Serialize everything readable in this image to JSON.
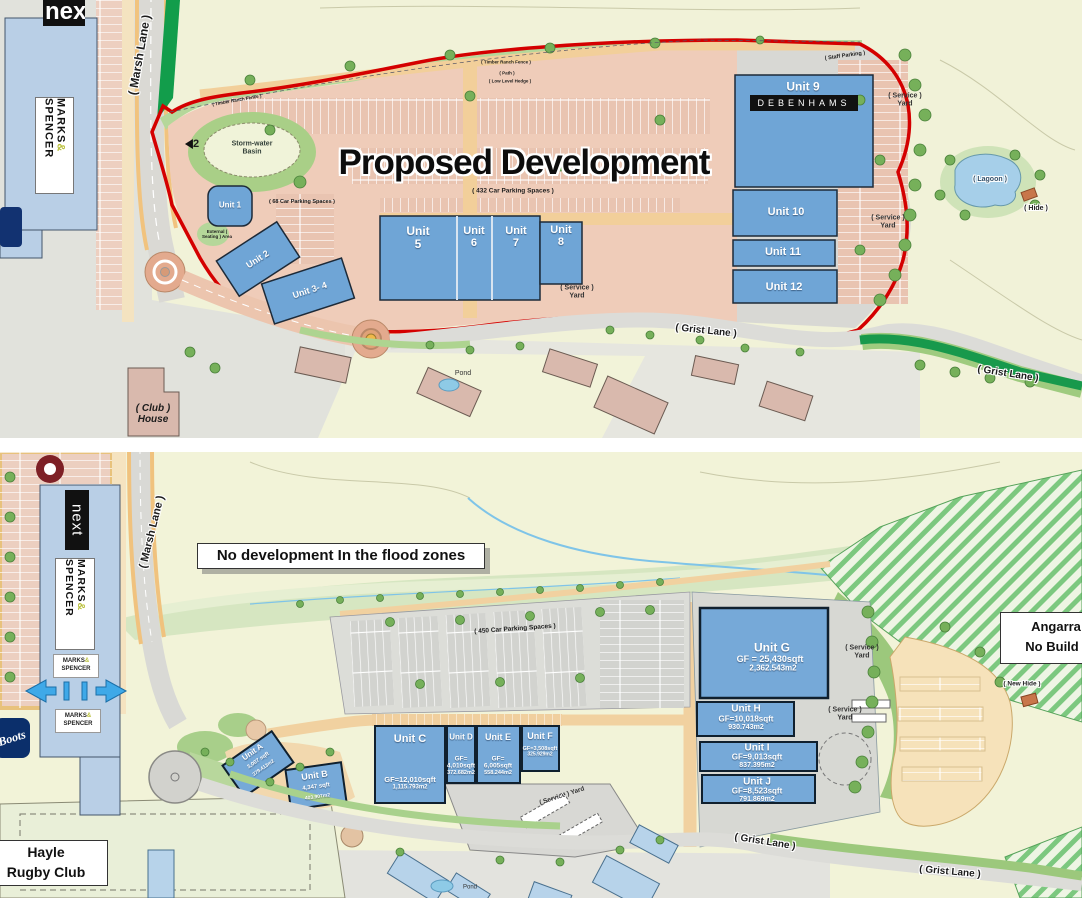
{
  "brands": {
    "next": "next",
    "marks_line1": "MARKS",
    "marks_amp": "&",
    "marks_line2": "SPENCER",
    "boots": "Boots"
  },
  "shared": {
    "service_line1": "( Service )",
    "service_line2": "Yard",
    "grist_lane": "( Grist Lane )",
    "marsh_lane": "( Marsh Lane )",
    "pond": "Pond"
  },
  "top_plan": {
    "title": "Proposed Development",
    "marker_2": "2",
    "storm_basin_l1": "Storm-water",
    "storm_basin_l2": "Basin",
    "parking_68": "( 68 Car Parking Spaces )",
    "parking_432": "( 432 Car Parking Spaces )",
    "external_seating": "External ( Seating ) Area",
    "staff_parking": "( Staff Parking )",
    "fence": "( Timber Ranch Fence )",
    "path": "( Path )",
    "hedge": "( Low Level Hedge )",
    "lagoon": "( Lagoon )",
    "hide": "( Hide )",
    "club_l1": "( Club )",
    "club_l2": "House",
    "units": {
      "u1": "Unit 1",
      "u2": "Unit 2",
      "u34": "Unit 3- 4",
      "u5w": "Unit",
      "u5n": "5",
      "u6w": "Unit",
      "u6n": "6",
      "u7w": "Unit",
      "u7n": "7",
      "u8w": "Unit",
      "u8n": "8",
      "u9": "Unit 9",
      "debenhams": "DEBENHAMS",
      "u10": "Unit 10",
      "u11": "Unit 11",
      "u12": "Unit 12"
    }
  },
  "bottom_plan": {
    "flood_note": "No development In the flood zones",
    "parking_450": "( 450 Car Parking Spaces )",
    "angarrack_l1": "Angarra",
    "angarrack_l2": "No Build (",
    "new_hide": "( New Hide )",
    "hayle_l1": "Hayle",
    "hayle_l2": "Rugby Club",
    "units": {
      "a_name": "Unit A",
      "a_sqft": "3,007 sqft",
      "a_m2": "279.413m2",
      "b_name": "Unit B",
      "b_sqft": "4,347 sqft",
      "b_m2": "403.907m2",
      "c_name": "Unit C",
      "c_gf": "GF=12,010sqft",
      "c_m2": "1,115.793m2",
      "d_name": "Unit D",
      "d_gf": "GF=",
      "d_sqft": "4,010sqft",
      "d_m2": "372.682m2",
      "e_name": "Unit E",
      "e_gf": "GF=",
      "e_sqft": "6,005sqft",
      "e_m2": "558.244m2",
      "f_name": "Unit F",
      "f_gf": "GF=3,508sqft",
      "f_m2": "325.929m2",
      "g_name": "Unit G",
      "g_gf": "GF = 25,430sqft",
      "g_m2": "2,362.543m2",
      "h_name": "Unit H",
      "h_gf": "GF=10,018sqft",
      "h_m2": "930.743m2",
      "i_name": "Unit I",
      "i_gf": "GF=9,013sqft",
      "i_m2": "837.395m2",
      "j_name": "Unit J",
      "j_gf": "GF=8,523sqft",
      "j_m2": "791.869m2"
    }
  },
  "colors": {
    "unit_blue": "#6FA5D6",
    "boundary_red": "#D40000",
    "ms_building_blue": "#B9CFE6",
    "flood_green": "#D6E6C1",
    "hatch_green": "#7CC87F"
  }
}
